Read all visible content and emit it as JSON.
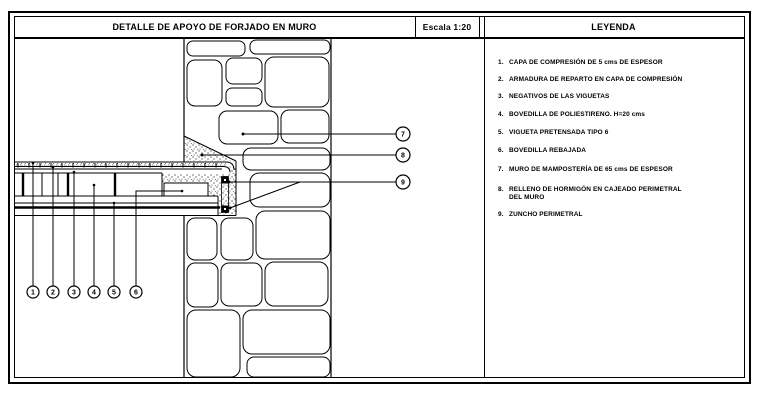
{
  "title_block": {
    "title": "DETALLE DE APOYO DE FORJADO EN MURO",
    "scale": "Escala 1:20"
  },
  "legend": {
    "title": "LEYENDA",
    "items": [
      {
        "num": "1.",
        "text": "CAPA DE COMPRESIÓN DE 5 cms DE ESPESOR"
      },
      {
        "num": "2.",
        "text": "ARMADURA DE REPARTO EN CAPA DE COMPRESIÓN"
      },
      {
        "num": "3.",
        "text": "NEGATIVOS DE LAS VIGUETAS"
      },
      {
        "num": "4.",
        "text": "BOVEDILLA DE POLIESTIRENO. H=20 cms"
      },
      {
        "num": "5.",
        "text": "VIGUETA PRETENSADA TIPO 6"
      },
      {
        "num": "6.",
        "text": "BOVEDILLA REBAJADA"
      },
      {
        "num": "7.",
        "text": "MURO DE MAMPOSTERÍA DE 65 cms DE ESPESOR"
      },
      {
        "num": "8.",
        "text": "RELLENO DE HORMIGÓN EN CAJEADO PERIMETRAL DEL MURO"
      },
      {
        "num": "9.",
        "text": "ZUNCHO PERIMETRAL"
      }
    ]
  },
  "drawing": {
    "callouts": [
      {
        "label": "1"
      },
      {
        "label": "2"
      },
      {
        "label": "3"
      },
      {
        "label": "4"
      },
      {
        "label": "5"
      },
      {
        "label": "6"
      },
      {
        "label": "7"
      },
      {
        "label": "8"
      },
      {
        "label": "9"
      }
    ]
  },
  "colors": {
    "line": "#000000",
    "background": "#ffffff",
    "stipple": "#333333"
  }
}
